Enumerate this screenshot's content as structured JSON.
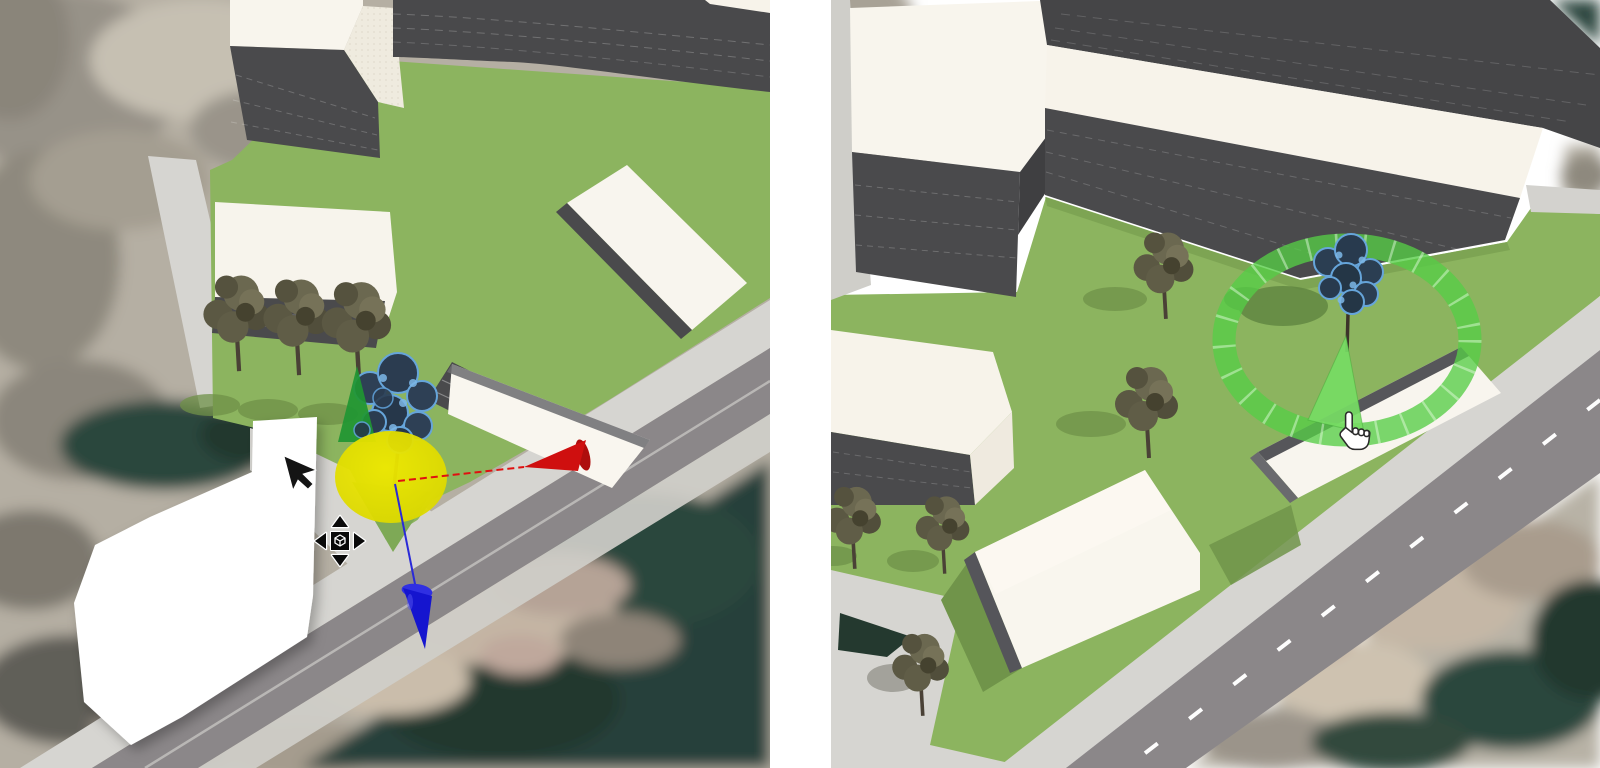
{
  "layout": {
    "width": 1600,
    "height": 768,
    "panel_gap_color": "#ffffff",
    "left_panel": {
      "x": 0,
      "width": 770
    },
    "right_panel": {
      "x": 831,
      "width": 769
    }
  },
  "colors": {
    "grass": "#8cb45f",
    "grass_shadow": "#70944a",
    "road": "#8b8789",
    "road_line": "#b9b7b5",
    "road_dash": "#fdfdfd",
    "sidewalk": "#d6d5d1",
    "curb": "#cfcec9",
    "wall_dark": "#4a4a4c",
    "roof_cream": "#f7f3ea",
    "water": "#24392f",
    "photo_base": "#b5afa3",
    "selection_outline": "#66a5da",
    "gizmo_yellow": "#e6e300",
    "gizmo_red": "#cf0f0f",
    "gizmo_blue": "#1515cf",
    "gizmo_green": "#1f9632",
    "rotate_ring_green": "#56cd46",
    "rotate_sector_green": "#76dc64",
    "white_surface": "#ffffff"
  },
  "icons": {
    "left_cursor": "arrow-cursor-icon",
    "left_cursor_modifier": "move-cursor-icon",
    "right_cursor": "hand-pointer-icon",
    "translate_gizmo": [
      "axis-arrow-red",
      "axis-arrow-blue",
      "axis-arrow-green",
      "origin-disc-yellow"
    ],
    "rotate_gizmo": [
      "rotation-ring",
      "rotation-sector"
    ]
  }
}
